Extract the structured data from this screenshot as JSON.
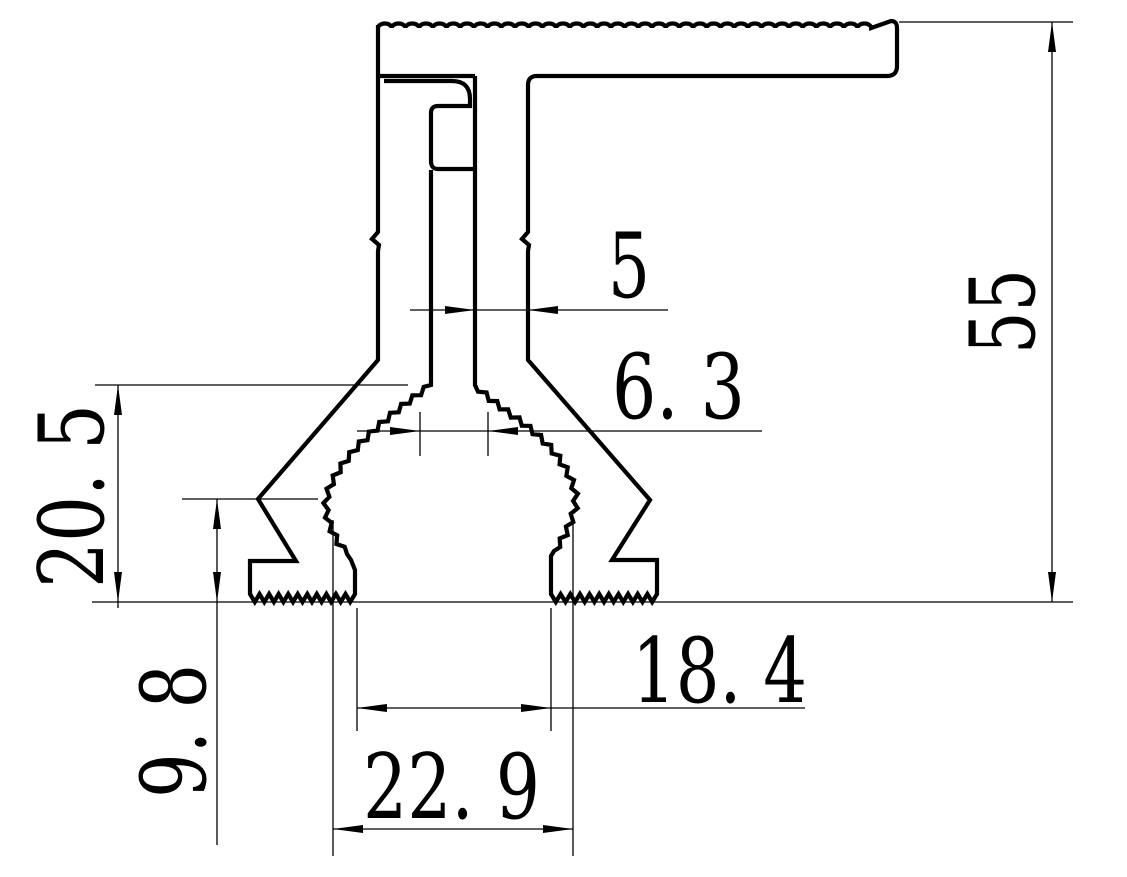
{
  "drawing": {
    "kind": "extrusion-profile-cross-section",
    "colors": {
      "line": "#000000",
      "background": "#ffffff"
    },
    "dimensions": {
      "overall_height": "55",
      "stem_width": "5",
      "waist_width": "6. 3",
      "clamp_height": "20. 5",
      "foot_height": "9. 8",
      "feet_inner_span": "18. 4",
      "base_width": "22. 9"
    }
  }
}
